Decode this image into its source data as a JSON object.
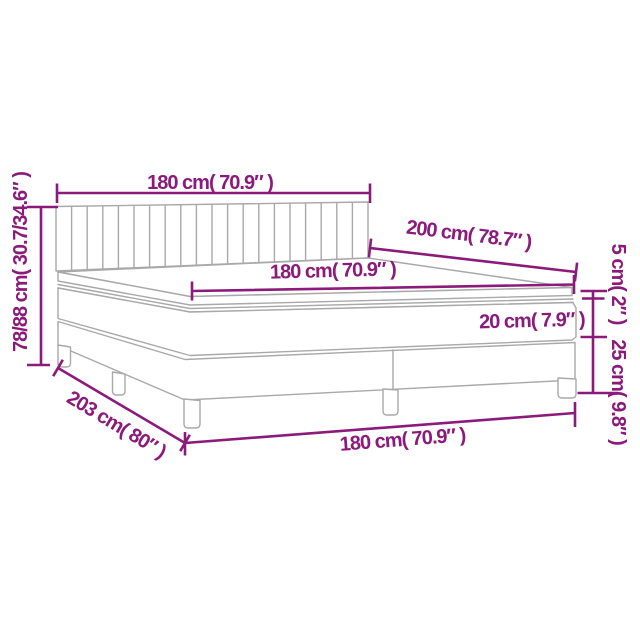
{
  "diagram": {
    "type": "product-dimension-diagram",
    "subject": "box spring bed with tufted headboard, mattress topper and two-piece base"
  },
  "colors": {
    "dimension": "#8c1a7b",
    "outline": "#a9a9a9",
    "background": "#ffffff"
  },
  "dimensions": {
    "headboard_width": "180 cm( 70.9″ )",
    "length_top": "200 cm( 78.7″ )",
    "mattress_width": "180 cm( 70.9″ )",
    "mattress_height": "20 cm( 7.9″ )",
    "topper_height": "5 cm( 2″ )",
    "base_height": "25 cm( 9.8″ )",
    "overall_height": "78/88 cm( 30.7/34.6″ )",
    "overall_length": "203 cm( 80″ )",
    "base_width": "180 cm( 70.9″ )"
  }
}
